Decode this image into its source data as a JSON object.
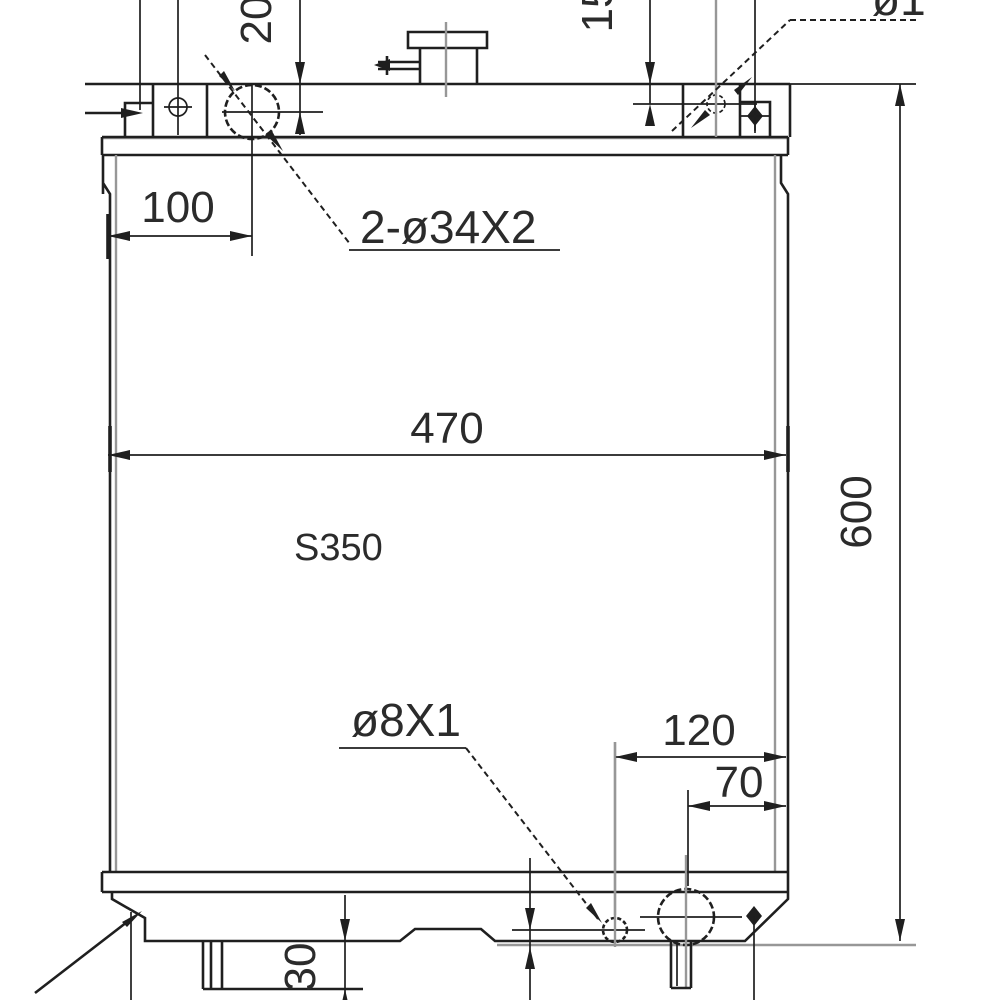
{
  "drawing": {
    "core_label": "S350",
    "dims": {
      "core_width": "470",
      "overall_height": "600",
      "inlet_offset_x": "100",
      "inlet_drop": "20",
      "bracket_hole_drop": "15",
      "drain_from_edge": "120",
      "outlet_from_edge": "70",
      "bottom_bracket_depth": "30"
    },
    "callouts": {
      "inlet_pipes": "2-ø34X2",
      "drain_pipe": "ø8X1",
      "bracket_hole_partial": "ø1"
    }
  }
}
